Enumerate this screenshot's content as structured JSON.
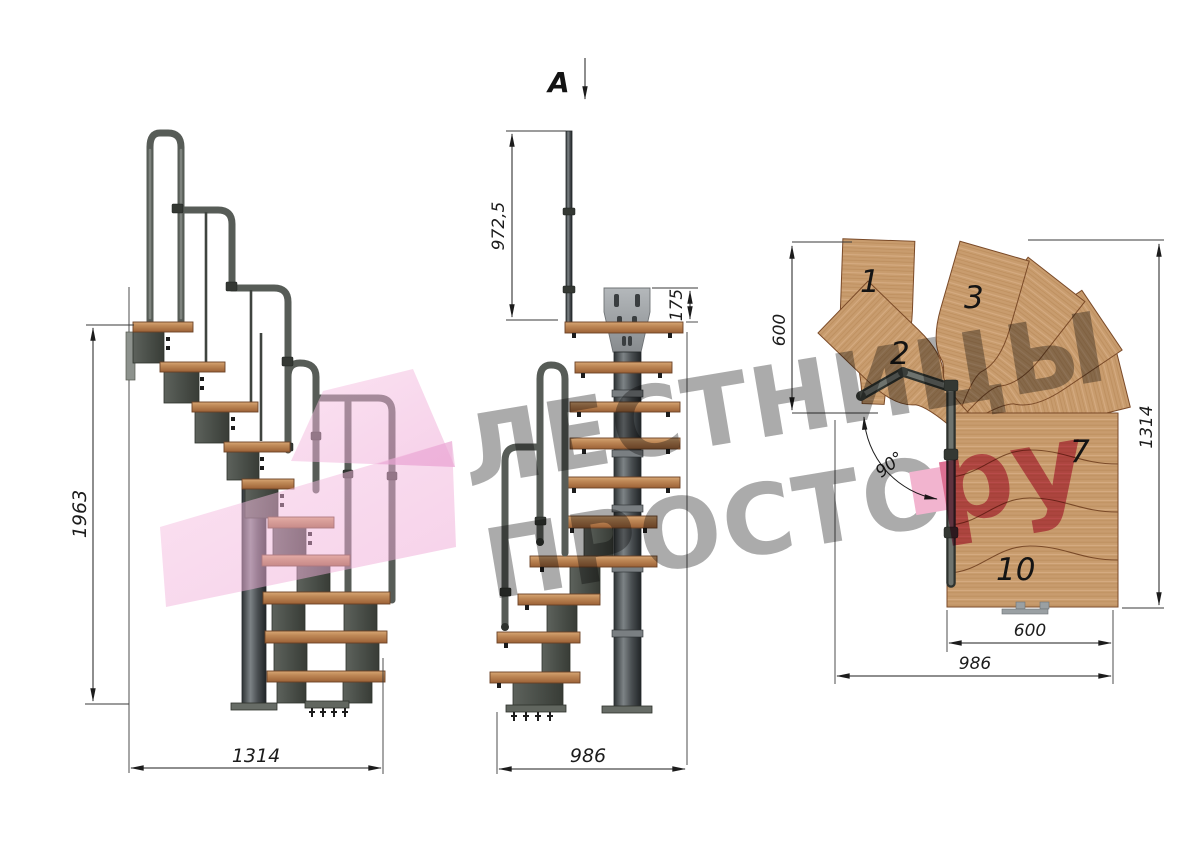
{
  "document": {
    "type": "staircase technical drawing",
    "subject": "modular staircase with 90-degree turn, three orthographic views"
  },
  "watermark": {
    "line1": "ЛЕСТНИЦЫ",
    "line2": "ПРОСТО",
    "dot": ".",
    "domain_suffix": "ру"
  },
  "views": {
    "side_elevation": {
      "dim_height": "1963",
      "dim_width": "1314"
    },
    "front_elevation": {
      "section_label": "A",
      "dim_handrail_height": "972,5",
      "dim_bracket": "175",
      "dim_width": "986"
    },
    "top_plan": {
      "dim_entry_width": "600",
      "dim_depth": "1314",
      "dim_step_width": "600",
      "dim_total_width": "986",
      "dim_turn_angle": "90°",
      "step_labels": {
        "step1": "1",
        "step2": "2",
        "step3": "3",
        "step7": "7",
        "step10": "10"
      }
    }
  },
  "palette": {
    "wood_light": "#d4a472",
    "wood_mid": "#c08a58",
    "wood_dark": "#a06538",
    "steel_dark": "#33383a",
    "steel_light": "#9aa0a3",
    "dim_line": "#1c1c1c",
    "watermark_gray": "#999999",
    "watermark_pink": "#d4507a",
    "watermark_dot_pink": "#f0a3c4",
    "ribbon_pink": "#f2aede"
  }
}
